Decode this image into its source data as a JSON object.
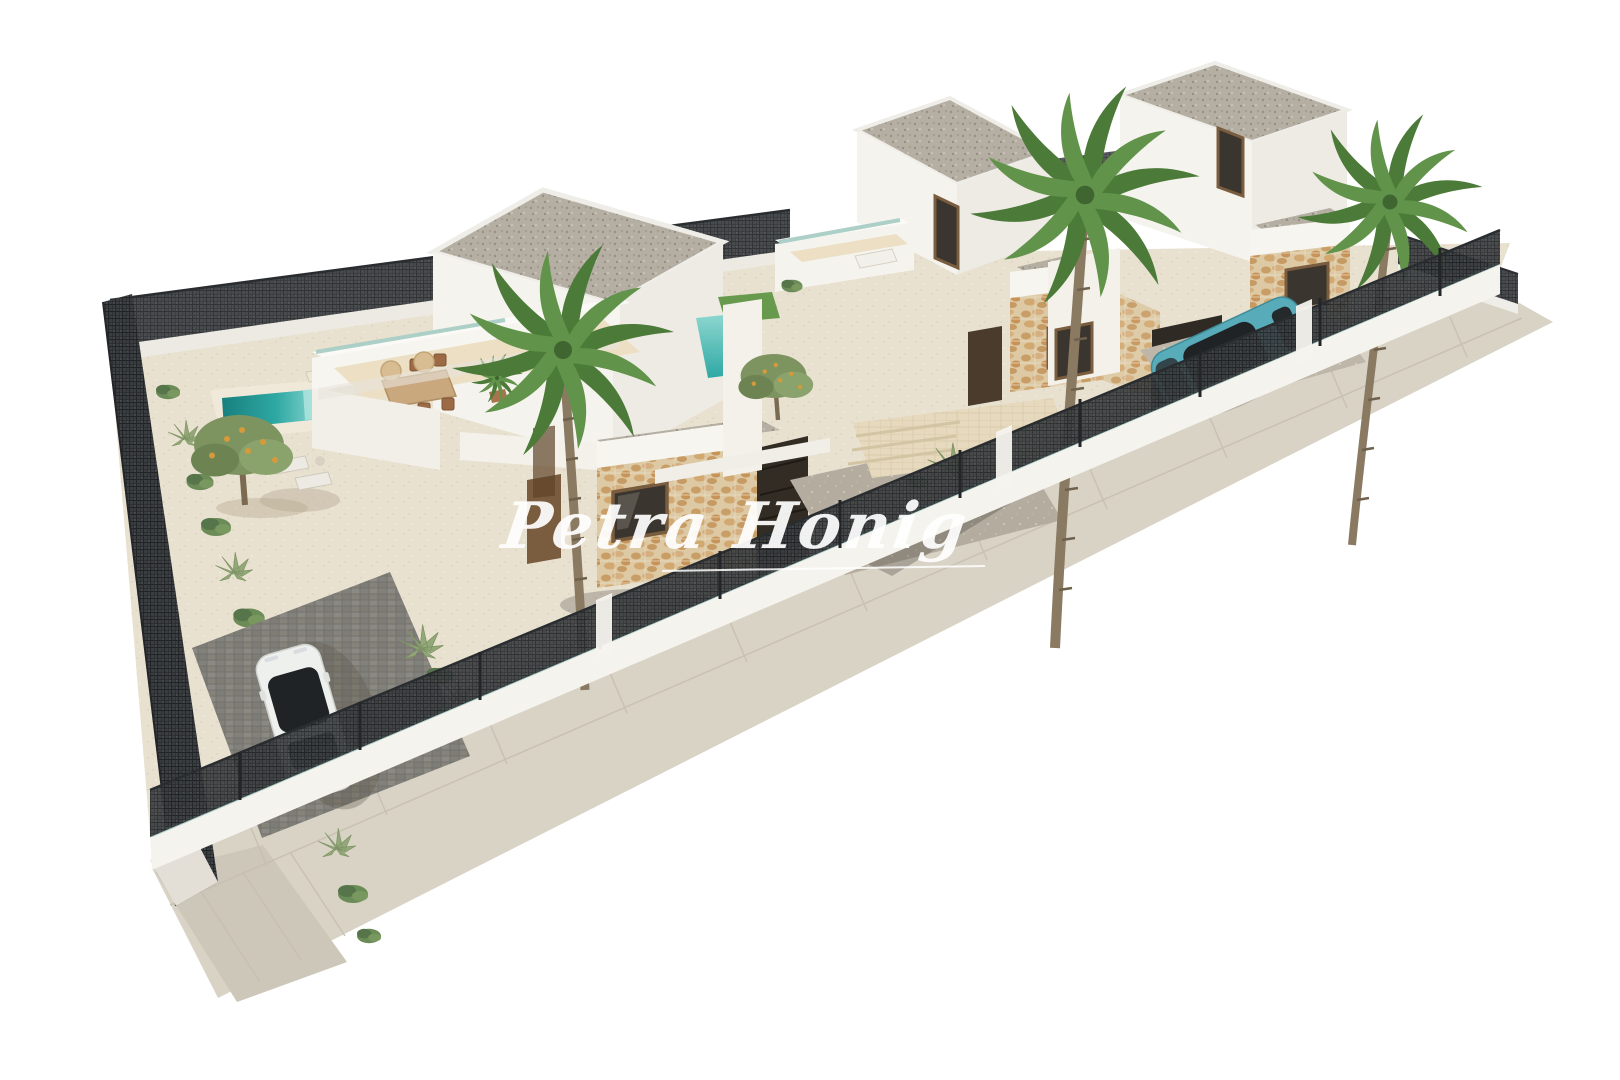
{
  "watermark": {
    "text": "Petra Honig"
  },
  "palette": {
    "background": "#ffffff",
    "ground_gravel": "#e9e1d0",
    "sidewalk": "#d9d3c6",
    "sidewalk_corner": "#cdc7b9",
    "wall_white": "#f5f3ee",
    "wall_shaded": "#e6e3dc",
    "fence_dark": "#3d4043",
    "glass_teal": "#a4ccc3",
    "pool_deep": "#17807e",
    "pool_mid": "#2fa8a4",
    "pool_light": "#8fd8d0",
    "grass_green": "#679a4c",
    "roof_gravel": "#b6b0a5",
    "stone_clad": "#ddc9a4",
    "wood_frame": "#7a5c3e",
    "door_dark": "#4a3b2c",
    "palm_green": "#5f8f45",
    "olive_green": "#7d9460",
    "trunk_brown": "#8a7a62",
    "car_white": "#eef0ee",
    "car_teal": "#58abb9",
    "car_glass": "#1f2326",
    "tail_red": "#6e1f24",
    "driveway_grey": "#8b8984",
    "parking_grey": "#b3ac9f",
    "path_beige": "#e6d9bd",
    "watermark_white": "#ffffff"
  }
}
